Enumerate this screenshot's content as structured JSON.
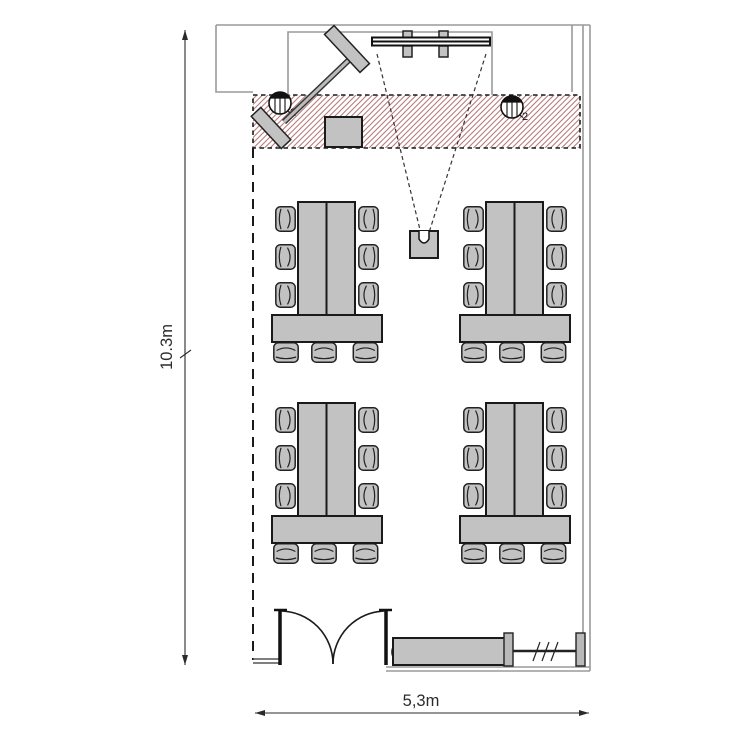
{
  "plan": {
    "dimensions": {
      "height_label": "10.3m",
      "width_label": "5,3m"
    },
    "lights": [
      {
        "label": "2"
      },
      {
        "label": "2"
      },
      {
        "label": "2"
      }
    ],
    "colors": {
      "background": "#ffffff",
      "furniture_fill": "#c2c2c2",
      "outline": "#1a1a1a",
      "wall": "#9a9a9a",
      "hatch_line": "#b87c7c"
    },
    "elements": {
      "table_groups": 4,
      "chairs_per_group": 9,
      "items": [
        "projection-screen",
        "projector",
        "flipchart",
        "side-table",
        "ceiling-light",
        "double-door",
        "radiator",
        "stage-hatch-area"
      ]
    }
  }
}
